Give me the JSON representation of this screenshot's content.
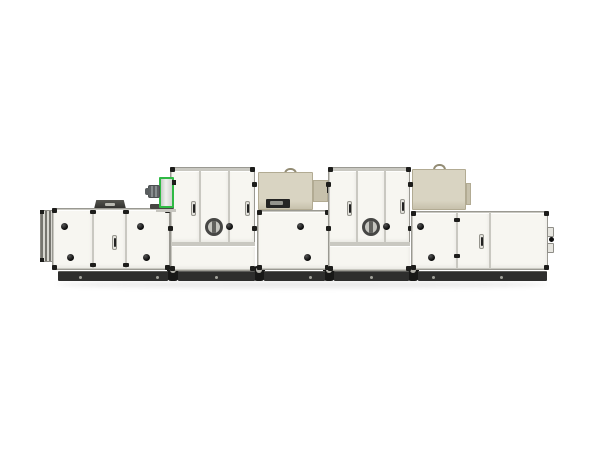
{
  "meta": {
    "title": "Product photo: modular air handling unit, side view on white background",
    "text_visible": "none"
  },
  "palette": {
    "background": "#ffffff",
    "panel_face": "#f7f6f1",
    "panel_seam": "#c9c8c1",
    "cabinet_border": "#9a9992",
    "bracket_dark": "#1d1d1b",
    "knob_black": "#0c0c0c",
    "porthole_ring": "#474745",
    "porthole_glass": "#c6c6c0",
    "porthole_bar": "#62625e",
    "beige_face": "#d9d4c2",
    "beige_shade": "#c7c1ac",
    "beige_trim": "#b2ab93",
    "slot_dark": "#242423",
    "slot_glass": "#93938c",
    "green_accent": "#2fb944",
    "fan_face_light": "#f0f1ef",
    "fan_face_dark": "#c7cac7",
    "motor_gray": "#888d8f",
    "base_dark": "#2e2e2d",
    "base_joint": "#181817",
    "base_dot": "#a3a39c",
    "louver_dark": "#76756f",
    "louver_light": "#d8d7d1",
    "hood_dark": "#2f2f2c",
    "shadow": "rgba(80,80,80,0.12)"
  },
  "components": {
    "unit": "modular air handling unit - side product view",
    "intake_louver": "intake louver flange",
    "filter_section": "left access section with weather hood",
    "weather_hood": "roof weather hood",
    "fan_assembly": "supply fan housing with motor (green trim)",
    "tower_1": "tall treatment section 1 with inspection window",
    "cassette_1": "top-mounted cassette box 1 with vent slot",
    "mid_section": "middle access section",
    "tower_2": "tall treatment section 2 with inspection window",
    "cassette_2": "top-mounted cassette box 2",
    "end_section": "right access section with service connections",
    "base_frame": "black base frame rails with joints",
    "inspection_window": "round inspection sight glass",
    "panel_knob": "round panel fastener knob",
    "panel_handle": "recessed panel handle"
  }
}
